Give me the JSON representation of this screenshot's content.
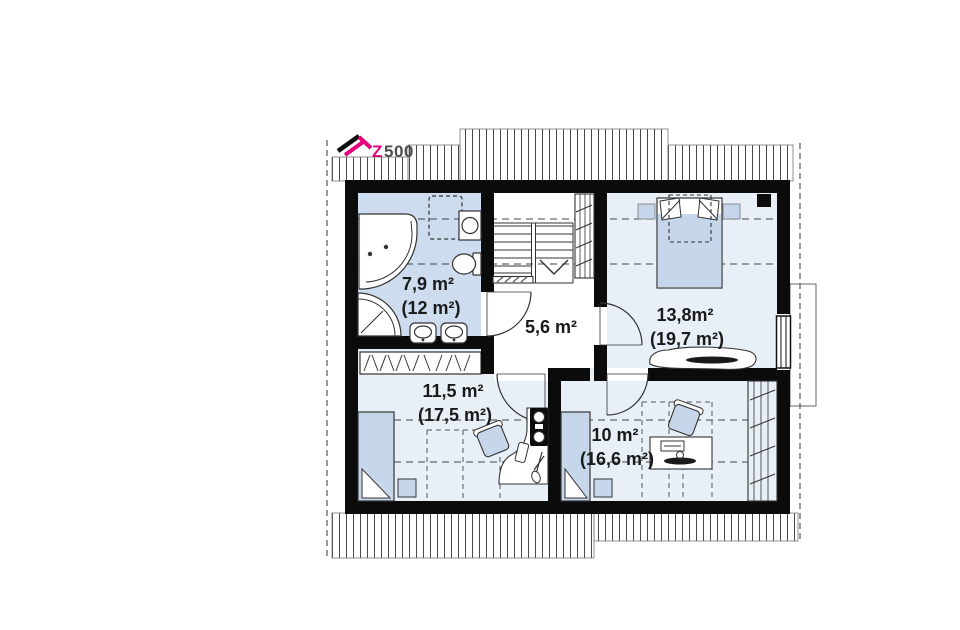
{
  "logo": {
    "brand_accent_letter": "Z",
    "brand_suffix": "500"
  },
  "rooms": {
    "bathroom": {
      "area": "7,9 m²",
      "total_area": "(12 m²)"
    },
    "hall": {
      "area": "5,6 m²"
    },
    "bedroom": {
      "area": "13,8m²",
      "total_area": "(19,7 m²)"
    },
    "room_left": {
      "area": "11,5 m²",
      "total_area": "(17,5 m²)"
    },
    "room_right": {
      "area": "10 m²",
      "total_area": "(16,6 m²)"
    }
  },
  "colors": {
    "accent": "#e5007d",
    "wall": "#0b0b0b",
    "bathroom_floor": "#cddcee",
    "room_floor": "#e9eff7",
    "furniture_blue": "#c7d7eb",
    "hatch_line": "#4a4a4a"
  }
}
